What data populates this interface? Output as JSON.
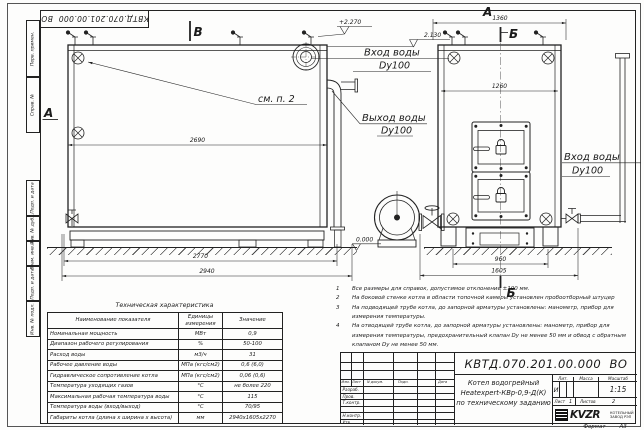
{
  "doc_number": "КВТД.070.201.00.000  ВО",
  "stamp_top": "КВТД.070.201.00.000  ВО",
  "frame_fields": [
    "Перв. примен.",
    "Справ. №",
    "Подп. и дата",
    "Инв. № дубл.",
    "Взам. инв. №",
    "Подп. и дата",
    "Инв. № подл."
  ],
  "labels": {
    "view_b": "В",
    "view_a": "А",
    "front_a": "А",
    "section_b_top": "Б",
    "section_b_bottom": "Б",
    "see_note": "см. п. 2",
    "elev_top": "+2.270",
    "elev_inlet": "2.130",
    "elev_zero": "0.000",
    "inlet_left_line1": "Вход воды",
    "inlet_left_line2": "Dу100",
    "outlet_line1": "Выход воды",
    "outlet_line2": "Dу100",
    "inlet_right_line1": "Вход воды",
    "inlet_right_line2": "Dу100"
  },
  "dims": {
    "side_body": "2690",
    "side_inner": "2770",
    "side_overall": "2940",
    "front_width": "1360",
    "front_inner": "1260",
    "front_base": "960",
    "front_overall": "1605"
  },
  "notes": [
    {
      "num": "1",
      "text": "Все размеры для справок, допустимое отклонение ±100 мм."
    },
    {
      "num": "2",
      "text": "На боковой стенке котла в области топочной камеры установлен пробоотборный штуцер"
    },
    {
      "num": "3",
      "text": "На  подводящей трубе котла, до запорной арматуры установлены: манометр, прибор для измерения температуры."
    },
    {
      "num": "4",
      "text": "На отводящей трубе котла, до запорной арматуры установлены: манометр, прибор для измерения температуры, предохранительный клапан Dу не менее 50 мм и обвод с обратным клапаном Dу не менее 50 мм."
    }
  ],
  "spec_table": {
    "title": "Техническая характеристика",
    "headers": [
      "Наименование показателя",
      "Единицы измерения",
      "Значение"
    ],
    "rows": [
      [
        "Номинальная мощность",
        "МВт",
        "0,9"
      ],
      [
        "Диапазон рабочего регулирования",
        "%",
        "50-100"
      ],
      [
        "Расход воды",
        "м3/ч",
        "31"
      ],
      [
        "Рабочее давление воды",
        "МПа (кгс/см2)",
        "0,6 (6,0)"
      ],
      [
        "Гидравлическое сопротивление котла",
        "МПа (кгс/см2)",
        "0,06 (0,6)"
      ],
      [
        "Температура уходящих газов",
        "°С",
        "не более 220"
      ],
      [
        "Максимальная рабочая температура воды",
        "°С",
        "115"
      ],
      [
        "Температура воды (вход/выход)",
        "°С",
        "70/95"
      ],
      [
        "Габариты котла (длина х ширина х высота)",
        "мм",
        "2940х1605х2270"
      ]
    ]
  },
  "title_block": {
    "sig_col_headers": [
      "Изм.",
      "Лист",
      "N докум.",
      "Подп.",
      "Дата"
    ],
    "sig_rows": [
      "Разраб.",
      "Пров.",
      "Т.контр.",
      "",
      "Н.контр.",
      "Утв."
    ],
    "product_line1": "Котел водогрейный",
    "product_line2": "Heatexpert-КВр-0,9-Д(К)",
    "product_line3": "по техническому заданию",
    "lit_header": "Лит.",
    "mass_header": "Масса",
    "scale_header": "Масштаб",
    "lit_value": "И",
    "scale_value": "1:15",
    "sheet_label": "Лист",
    "sheet_value": "1",
    "sheets_label": "Листов",
    "sheets_value": "2",
    "brand": "KVZR",
    "brand_sub1": "КОТЕЛЬНЫЙ",
    "brand_sub2": "ЗАВОД РЭП"
  },
  "format_label": "Формат",
  "format_value": "А3"
}
